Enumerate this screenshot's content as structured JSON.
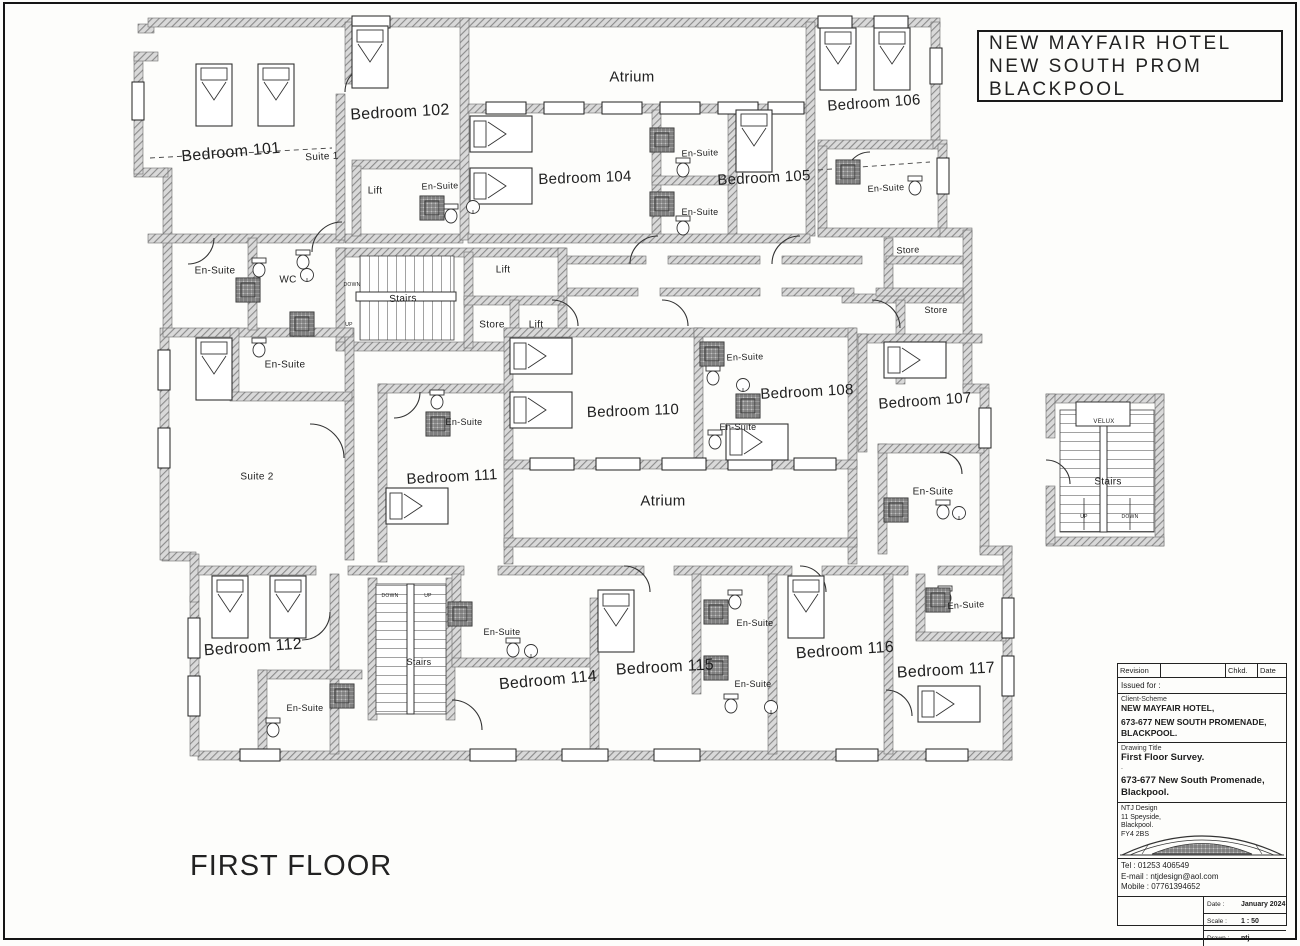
{
  "floor_title": "FIRST FLOOR",
  "title_block_top": {
    "lines": [
      "NEW MAYFAIR HOTEL",
      "NEW SOUTH PROM",
      "BLACKPOOL"
    ]
  },
  "plan": {
    "labels": [
      {
        "name": "atrium-north-label",
        "text": "Atrium",
        "x": 632,
        "y": 77,
        "size": 15,
        "rot": 0
      },
      {
        "name": "bedroom-101-label",
        "text": "Bedroom 101",
        "x": 231,
        "y": 153,
        "size": 16,
        "rot": -5
      },
      {
        "name": "bedroom-102-label",
        "text": "Bedroom 102",
        "x": 400,
        "y": 113,
        "size": 16,
        "rot": -3
      },
      {
        "name": "suite-1-label",
        "text": "Suite 1",
        "x": 322,
        "y": 157,
        "size": 10,
        "rot": -3
      },
      {
        "name": "lift-1-label",
        "text": "Lift",
        "x": 375,
        "y": 191,
        "size": 10,
        "rot": 0
      },
      {
        "name": "ensuite-102-label",
        "text": "En-Suite",
        "x": 440,
        "y": 186,
        "size": 9,
        "rot": -2
      },
      {
        "name": "bedroom-104-label",
        "text": "Bedroom 104",
        "x": 585,
        "y": 178,
        "size": 15,
        "rot": -2
      },
      {
        "name": "ensuite-104a-label",
        "text": "En-Suite",
        "x": 700,
        "y": 153,
        "size": 9,
        "rot": -2
      },
      {
        "name": "bedroom-105-label",
        "text": "Bedroom 105",
        "x": 764,
        "y": 178,
        "size": 15,
        "rot": -3
      },
      {
        "name": "ensuite-104b-label",
        "text": "En-Suite",
        "x": 700,
        "y": 212,
        "size": 9,
        "rot": 0
      },
      {
        "name": "bedroom-106-label",
        "text": "Bedroom 106",
        "x": 874,
        "y": 103,
        "size": 15,
        "rot": -4
      },
      {
        "name": "ensuite-106-label",
        "text": "En-Suite",
        "x": 886,
        "y": 188,
        "size": 9,
        "rot": -3
      },
      {
        "name": "store-1-label",
        "text": "Store",
        "x": 908,
        "y": 250,
        "size": 9,
        "rot": -3
      },
      {
        "name": "store-2-label",
        "text": "Store",
        "x": 936,
        "y": 310,
        "size": 9,
        "rot": 0
      },
      {
        "name": "ensuite-left1-label",
        "text": "En-Suite",
        "x": 215,
        "y": 271,
        "size": 10,
        "rot": 0
      },
      {
        "name": "wc-label",
        "text": "WC",
        "x": 288,
        "y": 280,
        "size": 10,
        "rot": 0
      },
      {
        "name": "stairs-left-down-label",
        "text": "DOWN",
        "x": 352,
        "y": 285,
        "size": 5,
        "rot": 0
      },
      {
        "name": "stairs-left-label",
        "text": "Stairs",
        "x": 403,
        "y": 299,
        "size": 10,
        "rot": -2
      },
      {
        "name": "stairs-left-up-label",
        "text": "UP",
        "x": 349,
        "y": 325,
        "size": 5,
        "rot": 0
      },
      {
        "name": "lift-2-label",
        "text": "Lift",
        "x": 503,
        "y": 270,
        "size": 10,
        "rot": 0
      },
      {
        "name": "store-3-label",
        "text": "Store",
        "x": 492,
        "y": 325,
        "size": 10,
        "rot": 0
      },
      {
        "name": "lift-3-label",
        "text": "Lift",
        "x": 536,
        "y": 325,
        "size": 10,
        "rot": 0
      },
      {
        "name": "ensuite-left2-label",
        "text": "En-Suite",
        "x": 285,
        "y": 365,
        "size": 10,
        "rot": 0
      },
      {
        "name": "suite-2-label",
        "text": "Suite 2",
        "x": 257,
        "y": 477,
        "size": 10,
        "rot": 0
      },
      {
        "name": "ensuite-108a-label",
        "text": "En-Suite",
        "x": 745,
        "y": 357,
        "size": 9,
        "rot": -2
      },
      {
        "name": "bedroom-108-label",
        "text": "Bedroom 108",
        "x": 807,
        "y": 392,
        "size": 15,
        "rot": -3
      },
      {
        "name": "ensuite-108b-label",
        "text": "En-Suite",
        "x": 738,
        "y": 427,
        "size": 9,
        "rot": 0
      },
      {
        "name": "bedroom-107-label",
        "text": "Bedroom 107",
        "x": 925,
        "y": 401,
        "size": 15,
        "rot": -4
      },
      {
        "name": "bedroom-110-label",
        "text": "Bedroom 110",
        "x": 633,
        "y": 411,
        "size": 15,
        "rot": -2
      },
      {
        "name": "ensuite-111-label",
        "text": "En-Suite",
        "x": 464,
        "y": 422,
        "size": 9,
        "rot": 0
      },
      {
        "name": "bedroom-111-label",
        "text": "Bedroom 111",
        "x": 452,
        "y": 477,
        "size": 15,
        "rot": -3
      },
      {
        "name": "atrium-center-label",
        "text": "Atrium",
        "x": 663,
        "y": 501,
        "size": 15,
        "rot": 0
      },
      {
        "name": "velux-label",
        "text": "VELUX",
        "x": 1104,
        "y": 422,
        "size": 6,
        "rot": 0
      },
      {
        "name": "stairs-right-label",
        "text": "Stairs",
        "x": 1108,
        "y": 482,
        "size": 10,
        "rot": 0
      },
      {
        "name": "stairs-right-up-label",
        "text": "UP",
        "x": 1084,
        "y": 517,
        "size": 5,
        "rot": 0
      },
      {
        "name": "stairs-right-down-label",
        "text": "DOWN",
        "x": 1130,
        "y": 517,
        "size": 5,
        "rot": 0
      },
      {
        "name": "ensuite-107-label",
        "text": "En-Suite",
        "x": 933,
        "y": 492,
        "size": 10,
        "rot": 0
      },
      {
        "name": "bedroom-112-label",
        "text": "Bedroom 112",
        "x": 253,
        "y": 648,
        "size": 16,
        "rot": -4
      },
      {
        "name": "stairs-bottom-down-label",
        "text": "DOWN",
        "x": 390,
        "y": 596,
        "size": 5,
        "rot": 0
      },
      {
        "name": "stairs-bottom-up-label",
        "text": "UP",
        "x": 428,
        "y": 596,
        "size": 5,
        "rot": 0
      },
      {
        "name": "stairs-bottom-label",
        "text": "Stairs",
        "x": 419,
        "y": 662,
        "size": 9,
        "rot": 0
      },
      {
        "name": "ensuite-114-label",
        "text": "En-Suite",
        "x": 502,
        "y": 632,
        "size": 9,
        "rot": 0
      },
      {
        "name": "ensuite-112-label",
        "text": "En-Suite",
        "x": 305,
        "y": 708,
        "size": 9,
        "rot": 0
      },
      {
        "name": "bedroom-114-label",
        "text": "Bedroom 114",
        "x": 548,
        "y": 681,
        "size": 16,
        "rot": -5
      },
      {
        "name": "ensuite-115a-label",
        "text": "En-Suite",
        "x": 755,
        "y": 623,
        "size": 9,
        "rot": 0
      },
      {
        "name": "bedroom-115-label",
        "text": "Bedroom 115",
        "x": 665,
        "y": 668,
        "size": 16,
        "rot": -3
      },
      {
        "name": "ensuite-115b-label",
        "text": "En-Suite",
        "x": 753,
        "y": 684,
        "size": 9,
        "rot": 0
      },
      {
        "name": "bedroom-116-label",
        "text": "Bedroom 116",
        "x": 845,
        "y": 651,
        "size": 16,
        "rot": -4
      },
      {
        "name": "bedroom-117-label",
        "text": "Bedroom 117",
        "x": 946,
        "y": 671,
        "size": 16,
        "rot": -3
      },
      {
        "name": "ensuite-117-label",
        "text": "En-Suite",
        "x": 966,
        "y": 605,
        "size": 9,
        "rot": -3
      }
    ]
  },
  "title_block": {
    "revision_label": "Revision",
    "chkd_label": "Chkd.",
    "date_col_label": "Date",
    "issued_for_label": "Issued for :",
    "client_scheme_label": "Client-Scheme",
    "client_lines": [
      "NEW MAYFAIR HOTEL,",
      "673-677 NEW SOUTH PROMENADE,",
      "BLACKPOOL."
    ],
    "drawing_title_label": "Drawing Title",
    "drawing_title": "First Floor Survey.",
    "spacer_dot": ".",
    "address_lines": [
      "673-677 New South Promenade,",
      "Blackpool."
    ],
    "firm_lines": [
      "NTJ Design",
      "11 Speyside,",
      "Blackpool.",
      "FY4 2BS"
    ],
    "tel": "Tel : 01253 406549",
    "email": "E-mail : ntjdesign@aol.com",
    "mobile": "Mobile : 07761394652",
    "date_field_label": "Date :",
    "date_value": "January 2024",
    "scale_field_label": "Scale :",
    "scale_value": "1 : 50",
    "drawn_field_label": "Drawn :",
    "drawn_value": "ntj",
    "checked_field_label": "Checked :",
    "checked_value": "",
    "drawing_no_label": "Drawing No.",
    "drawing_no_value": "A997/2"
  },
  "colors": {
    "wall_gray": "#9a9a9a",
    "line_dark": "#2a2a2a",
    "paper": "#fdfdfb"
  }
}
